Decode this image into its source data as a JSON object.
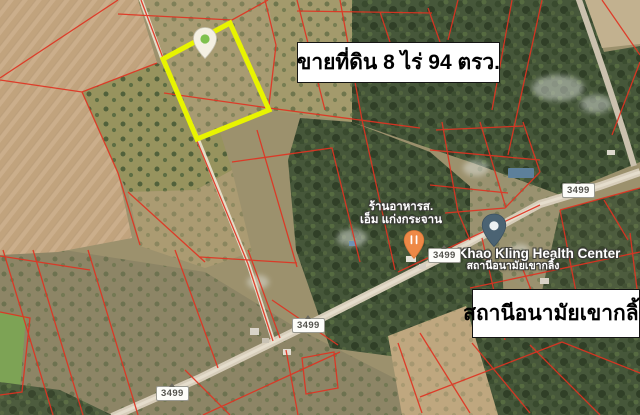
{
  "map": {
    "for_sale_sign": "ขายที่ดิน 8 ไร่ 94 ตรว.",
    "health_station_sign": "สถานีอนามัยเขากลิ้ง",
    "poi": {
      "restaurant_name_line1": "ร้านอาหารส.",
      "restaurant_name_line2": "เอ็ม แก่งกระจาน",
      "health_center_name_en": "Khao Kling Health Center",
      "health_center_name_th": "สถานีอนามัยเขากลิ้ง"
    },
    "road_badges": [
      {
        "route": "3499"
      },
      {
        "route": "3499"
      },
      {
        "route": "3499"
      },
      {
        "route": "3499"
      }
    ],
    "icons": {
      "property_pin": "property-pin",
      "restaurant_pin": "restaurant-pin",
      "health_pin": "place-pin"
    },
    "colors": {
      "cadastral_line": "#df3322",
      "highlight_parcel": "#e8f400",
      "restaurant_pin": "#ee8947",
      "health_pin": "#4b6373",
      "property_pin_dot": "#7fc14e",
      "field_tan": "#c9ac89",
      "forest_green": "#46573a"
    }
  }
}
